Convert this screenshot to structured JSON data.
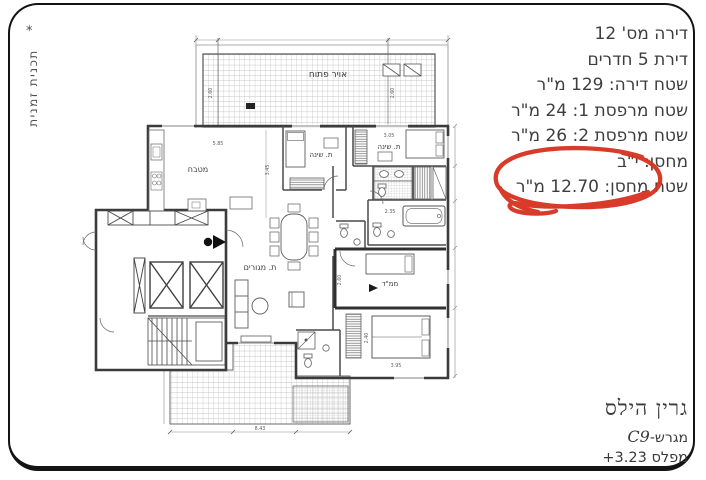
{
  "side_note": {
    "marker": "*",
    "text": "תכנית זמנית"
  },
  "info_panel": {
    "lines": [
      {
        "text": "דירה מס' 12"
      },
      {
        "text": "דירת 5 חדרים"
      },
      {
        "text": "שטח דירה: 129 מ\"ר"
      },
      {
        "text": "שטח מרפסת 1: 24 מ\"ר"
      },
      {
        "text": "שטח מרפסת 2: 26 מ\"ר"
      },
      {
        "text": "מחסן: י\"ב"
      },
      {
        "text": "שטח מחסן: 12.70 מ\"ר",
        "highlighted": true
      }
    ]
  },
  "annotation": {
    "type": "hand-drawn-circle",
    "color": "#d6311e"
  },
  "project_block": {
    "name": "גרין הילס",
    "lot_label": "מגרש-",
    "lot_value": "C9",
    "level_label": "מפלס",
    "level_value": "+3.23"
  },
  "plan": {
    "labels": {
      "open_air": "אויר פתוח",
      "kitchen": "מטבח",
      "bedroom1": "ת. שינה",
      "bedroom2": "ת. שינה",
      "living": "ת. מגורים",
      "safe_room": "ממ\"ד"
    },
    "dims": {
      "w585": "5.85",
      "w345": "3.45",
      "w305": "3.05",
      "w235": "2.35",
      "w260": "2.60",
      "w395": "3.95",
      "w240": "2.40",
      "w843": "8.43"
    }
  }
}
